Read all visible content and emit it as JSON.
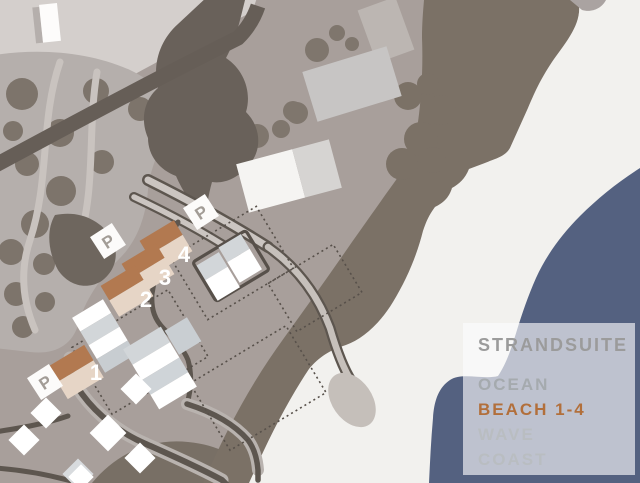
{
  "legend": {
    "title": "STRANDSUITE",
    "items": [
      {
        "label": "OCEAN",
        "highlight": false
      },
      {
        "label": "BEACH 1-4",
        "highlight": true
      },
      {
        "label": "WAVE",
        "highlight": false
      },
      {
        "label": "COAST",
        "highlight": false
      }
    ]
  },
  "map": {
    "parking_label": "P",
    "unit_numbers": [
      "1",
      "2",
      "3",
      "4"
    ]
  },
  "colors": {
    "ocean": "#546180",
    "beach": "#f2f1ee",
    "dune": "#7b7166",
    "ground": "#a89f9b",
    "ground_light": "#d4cfcc",
    "grove": "#b5afac",
    "tree": "#7d746b",
    "road": "#5d564f",
    "building_roof": "#d2d6d9",
    "highlight_roof": "#b27950",
    "highlight_wall": "#e6d5c6",
    "legend_highlight": "#b26f3b",
    "legend_text": "#9b9b9b"
  }
}
